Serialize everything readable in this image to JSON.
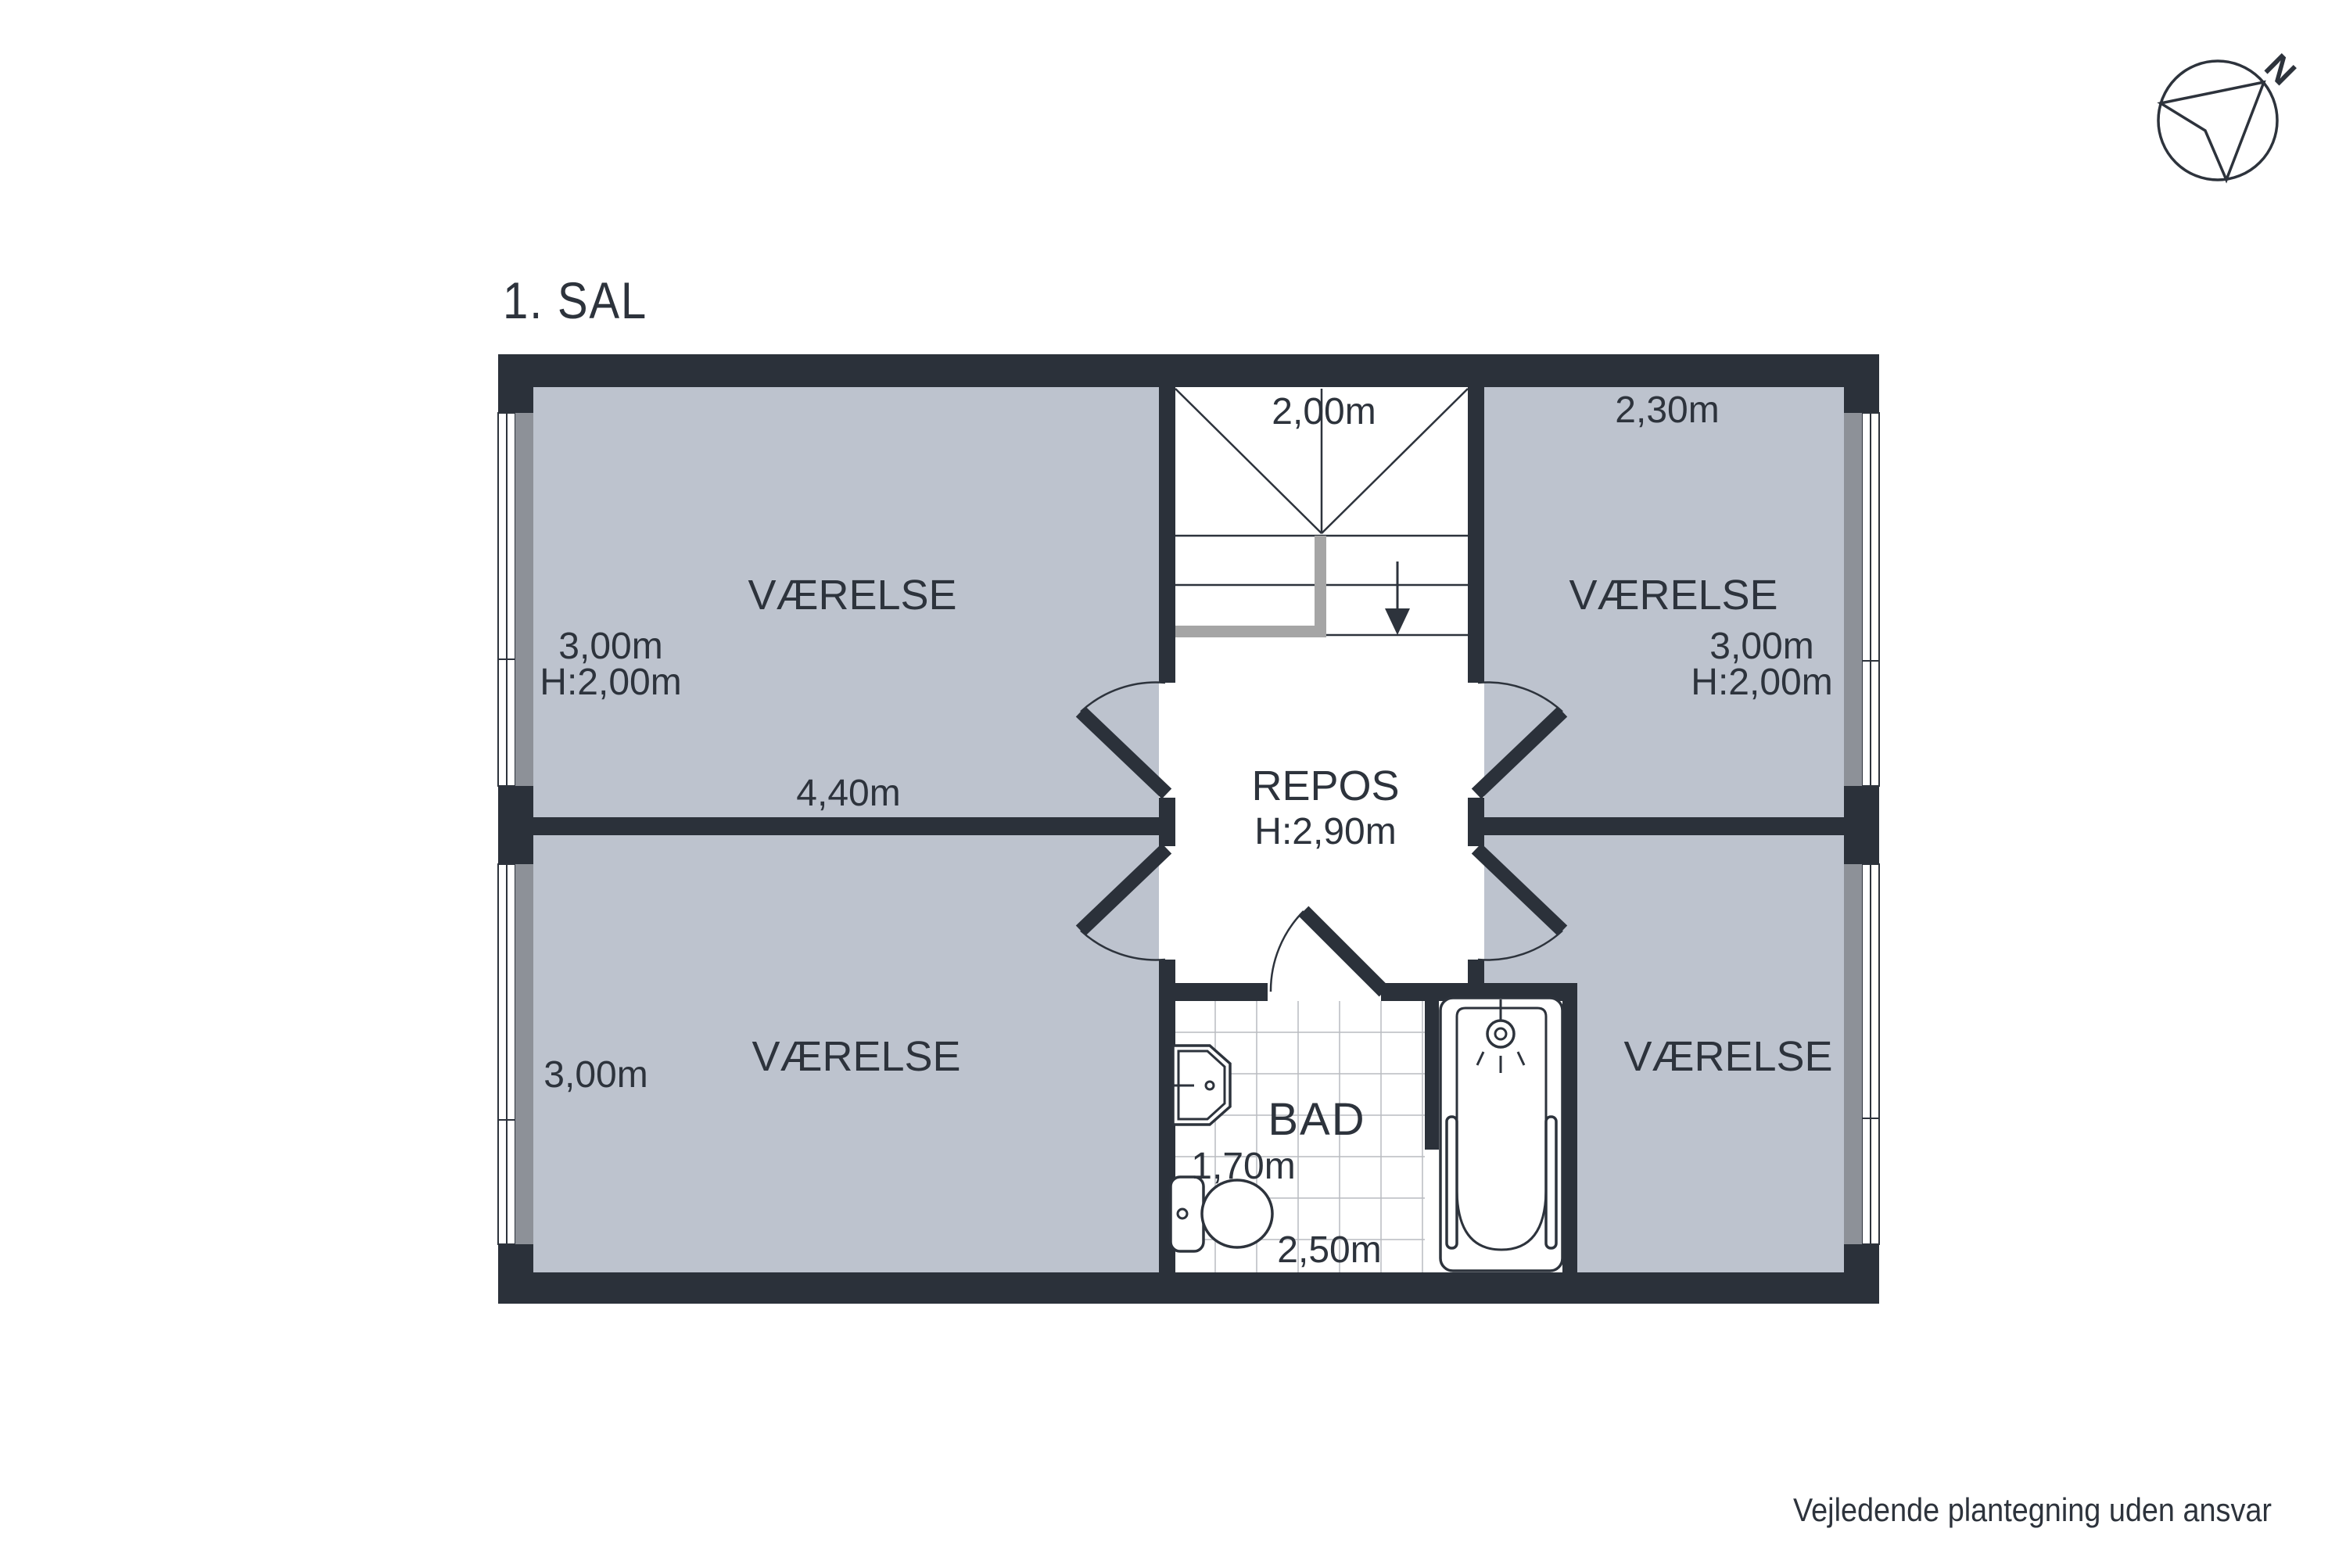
{
  "title": "1. SAL",
  "footer": "Vejledende plantegning uden ansvar",
  "compass": {
    "north_label": "N"
  },
  "plan": {
    "rooms": {
      "room_top_left": {
        "name": "VÆRELSE",
        "width": "3,00m",
        "ceiling": "H:2,00m",
        "length": "4,40m"
      },
      "room_top_right": {
        "name": "VÆRELSE",
        "width": "3,00m",
        "ceiling": "H:2,00m",
        "top": "2,30m"
      },
      "room_bottom_left": {
        "name": "VÆRELSE",
        "width": "3,00m"
      },
      "room_bottom_right": {
        "name": "VÆRELSE"
      },
      "landing": {
        "name": "REPOS",
        "ceiling": "H:2,90m"
      },
      "bathroom": {
        "name": "BAD",
        "width": "1,70m",
        "length": "2,50m"
      },
      "stairs": {
        "width": "2,00m"
      }
    },
    "colors": {
      "wall": "#2b313a",
      "room_fill": "#bdc3ce",
      "window_sill": "#8d9198",
      "text": "#2d333c",
      "stair_rail": "#a5a5a5",
      "tile_line": "#b9bcc0"
    }
  }
}
